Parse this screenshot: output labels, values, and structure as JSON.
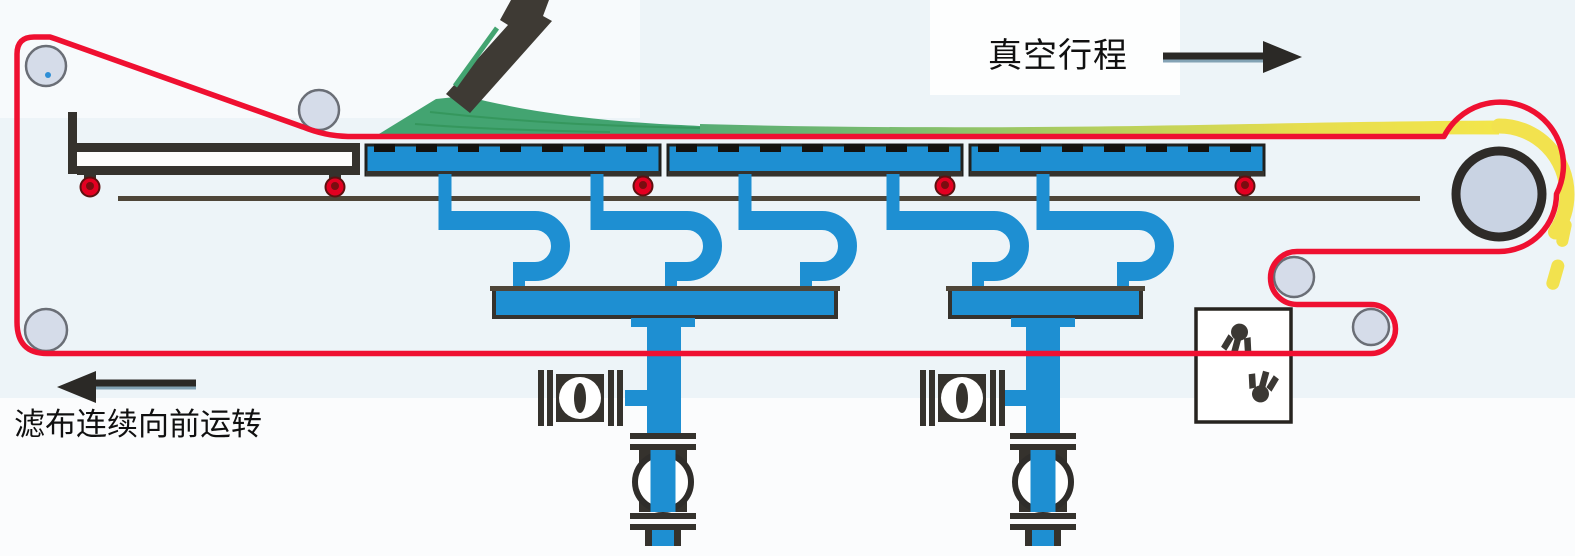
{
  "labels": {
    "vacuum_stroke": "真空行程",
    "cloth_forward": "滤布连续向前运转"
  },
  "colors": {
    "background": "#EDF4F8",
    "pipe_blue": "#1E8FD2",
    "belt_red": "#EF1031",
    "slurry_green": "#43A471",
    "cake_yellow": "#F2E24E",
    "roller_gray": "#D5DCE9",
    "drum_gray": "#C9D3E3",
    "outline_dark": "#35322D",
    "rail_brown": "#4E4538",
    "wheel_red": "#E30021"
  },
  "icons": [
    {
      "name": "right-arrow-icon",
      "meaning": "direction of vacuum stroke"
    },
    {
      "name": "left-arrow-icon",
      "meaning": "direction of filter cloth travel"
    },
    {
      "name": "spray-nozzle-icon-top",
      "meaning": "cloth wash spray"
    },
    {
      "name": "spray-nozzle-icon-bottom",
      "meaning": "cloth wash spray"
    }
  ],
  "parts": {
    "vacuum_boxes": 3,
    "filtrate_manifolds": 2,
    "suction_elbows": 5,
    "support_wheels": 5,
    "belt_rollers": 5,
    "drive_drum": 1,
    "inline_valves": 2,
    "side_valves": 2,
    "cake_discharge_chunks": 2
  }
}
